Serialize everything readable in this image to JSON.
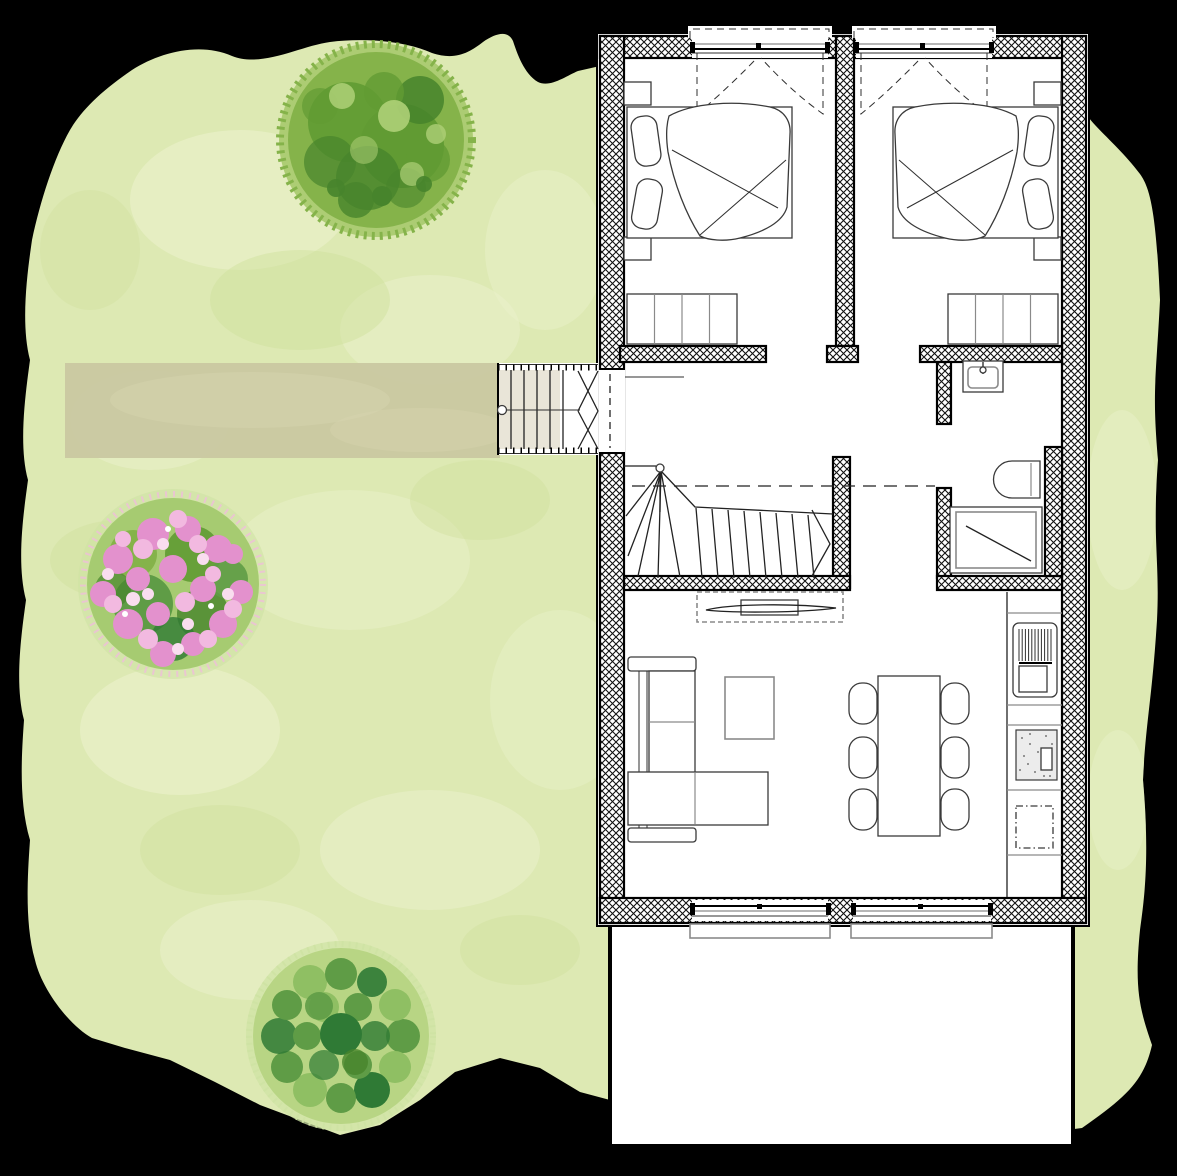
{
  "scene": {
    "type": "architectural-floor-plan-with-garden",
    "canvas": {
      "width": 1177,
      "height": 1176
    }
  },
  "palette": {
    "background": "#000000",
    "lawn": "#dde9b3",
    "lawn_light": "#ecf2cd",
    "lawn_shadow": "#cfdf9b",
    "path": "#c9c7a0",
    "path_light": "#d6d4ae",
    "tree_edge": "#a6c96b",
    "tree_base": "#85b34a",
    "tree_mid": "#619b33",
    "tree_dark": "#47842c",
    "tree_light": "#aed077",
    "shrub_halo": "#cfe3a4",
    "shrub_base": "#b8d584",
    "shrub_mid": "#5f9c46",
    "shrub_dark": "#2f7a35",
    "shrub_light": "#8fbf63",
    "bush_green": "#a3c96e",
    "blossom_pink": "#e391cd",
    "blossom_light": "#f2b9e0",
    "blossom_pale": "#f9ddef",
    "plan_paper": "#ffffff",
    "wall_ink": "#000000",
    "stair_tread": "#e9e5d8",
    "sink_fill": "#ececec"
  },
  "elements": {
    "garden": [
      "lawn",
      "garden-path",
      "large-tree",
      "flowering-shrub",
      "round-shrub"
    ],
    "building_zones": [
      "bedroom-1",
      "bedroom-2",
      "hallway",
      "winder-staircase",
      "bathroom",
      "living-dining-room",
      "kitchen",
      "terrace",
      "entrance-stairs"
    ],
    "furniture_symbols": [
      "double-bed",
      "pillow",
      "duvet",
      "nightstand",
      "wardrobe",
      "washbasin",
      "toilet",
      "shower",
      "cooktop",
      "oven",
      "kitchen-sink",
      "dishwasher",
      "kitchen-counter",
      "sofa",
      "coffee-table",
      "tv-sideboard",
      "dining-table",
      "dining-chair"
    ],
    "opening_symbols": [
      "casement-window",
      "sliding-window",
      "entrance-door",
      "window-sill",
      "roof-overhang-dashed",
      "stair-walk-line"
    ],
    "counts": {
      "trees": 2,
      "flowering_shrubs": 1,
      "bedrooms": 2,
      "beds": 2,
      "wardrobes": 2,
      "nightstands": 4,
      "dining_chairs": 6,
      "top_windows": 2,
      "bottom_windows": 2
    }
  }
}
